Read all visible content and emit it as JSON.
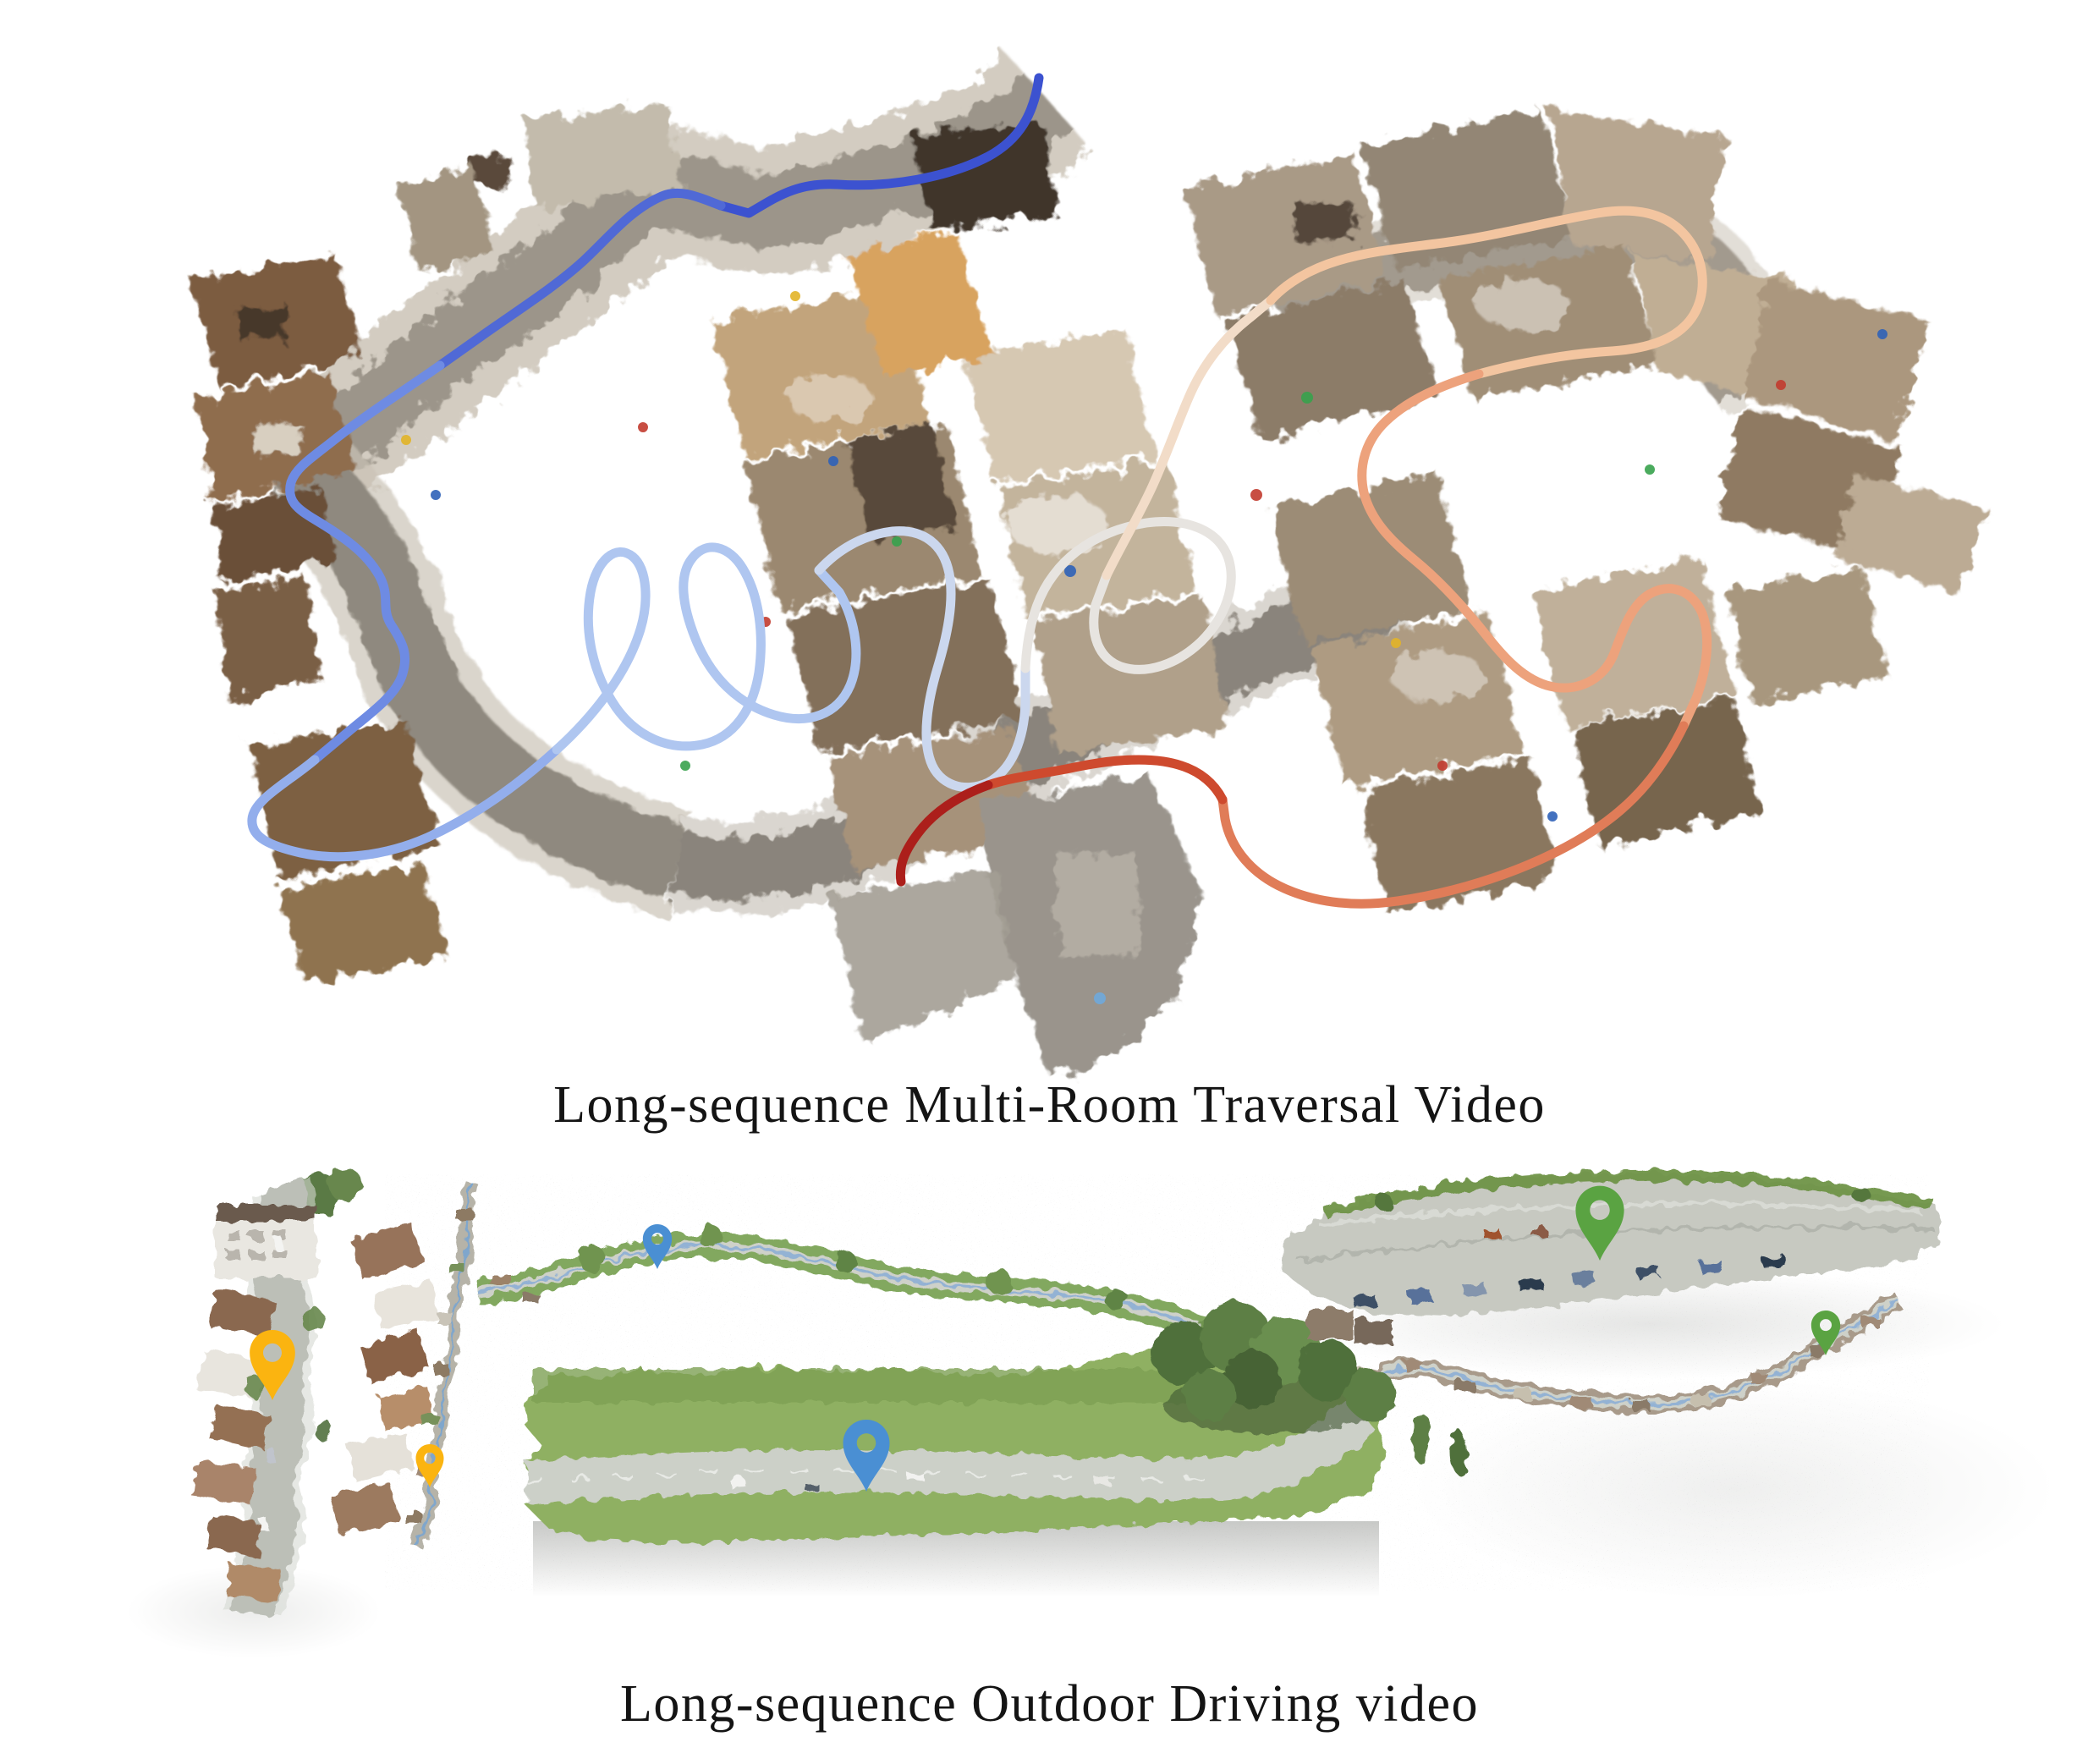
{
  "captions": {
    "indoor": "Long-sequence Multi-Room Traversal Video",
    "outdoor": "Long-sequence Outdoor Driving video"
  },
  "indoor_map": {
    "description": "Top-down colored point cloud of a long multi-room indoor traversal with a time-colored camera trajectory",
    "trajectory": {
      "segment_colors": [
        "#3C52D0",
        "#5069D6",
        "#6E8BE3",
        "#93AEEC",
        "#AFC6F0",
        "#CBD7EE",
        "#E7E4E0",
        "#F2DCC8",
        "#F3C5A0",
        "#EDA27C",
        "#E07C58",
        "#CE4A2E",
        "#AC1F1B"
      ]
    },
    "palette": {
      "corridor_gray": "#9c958a",
      "sidewalk_light": "#cbc3b6",
      "room_tan": "#c2a47c",
      "room_brown": "#8f6d4e",
      "floor_orange": "#d8a35f"
    }
  },
  "outdoor_map": {
    "description": "Point-cloud strips of a long outdoor driving route: village street, winding rural road, close-up road, and urban street",
    "pins": [
      {
        "name": "pin-yellow-large",
        "color": "#FBB410",
        "size": "large"
      },
      {
        "name": "pin-yellow-small",
        "color": "#FBB410",
        "size": "small"
      },
      {
        "name": "pin-blue-small",
        "color": "#4A8FD3",
        "size": "small"
      },
      {
        "name": "pin-blue-large",
        "color": "#4A8FD3",
        "size": "large"
      },
      {
        "name": "pin-green-large",
        "color": "#5AA342",
        "size": "large"
      },
      {
        "name": "pin-green-small",
        "color": "#5AA342",
        "size": "small"
      }
    ],
    "palette": {
      "road_gray": "#c7c9c1",
      "grass_green": "#8fb062",
      "hedge_green": "#6f9447",
      "route_blue_line": "#93b2d4",
      "speckle_gray": "#9a9a96"
    }
  }
}
